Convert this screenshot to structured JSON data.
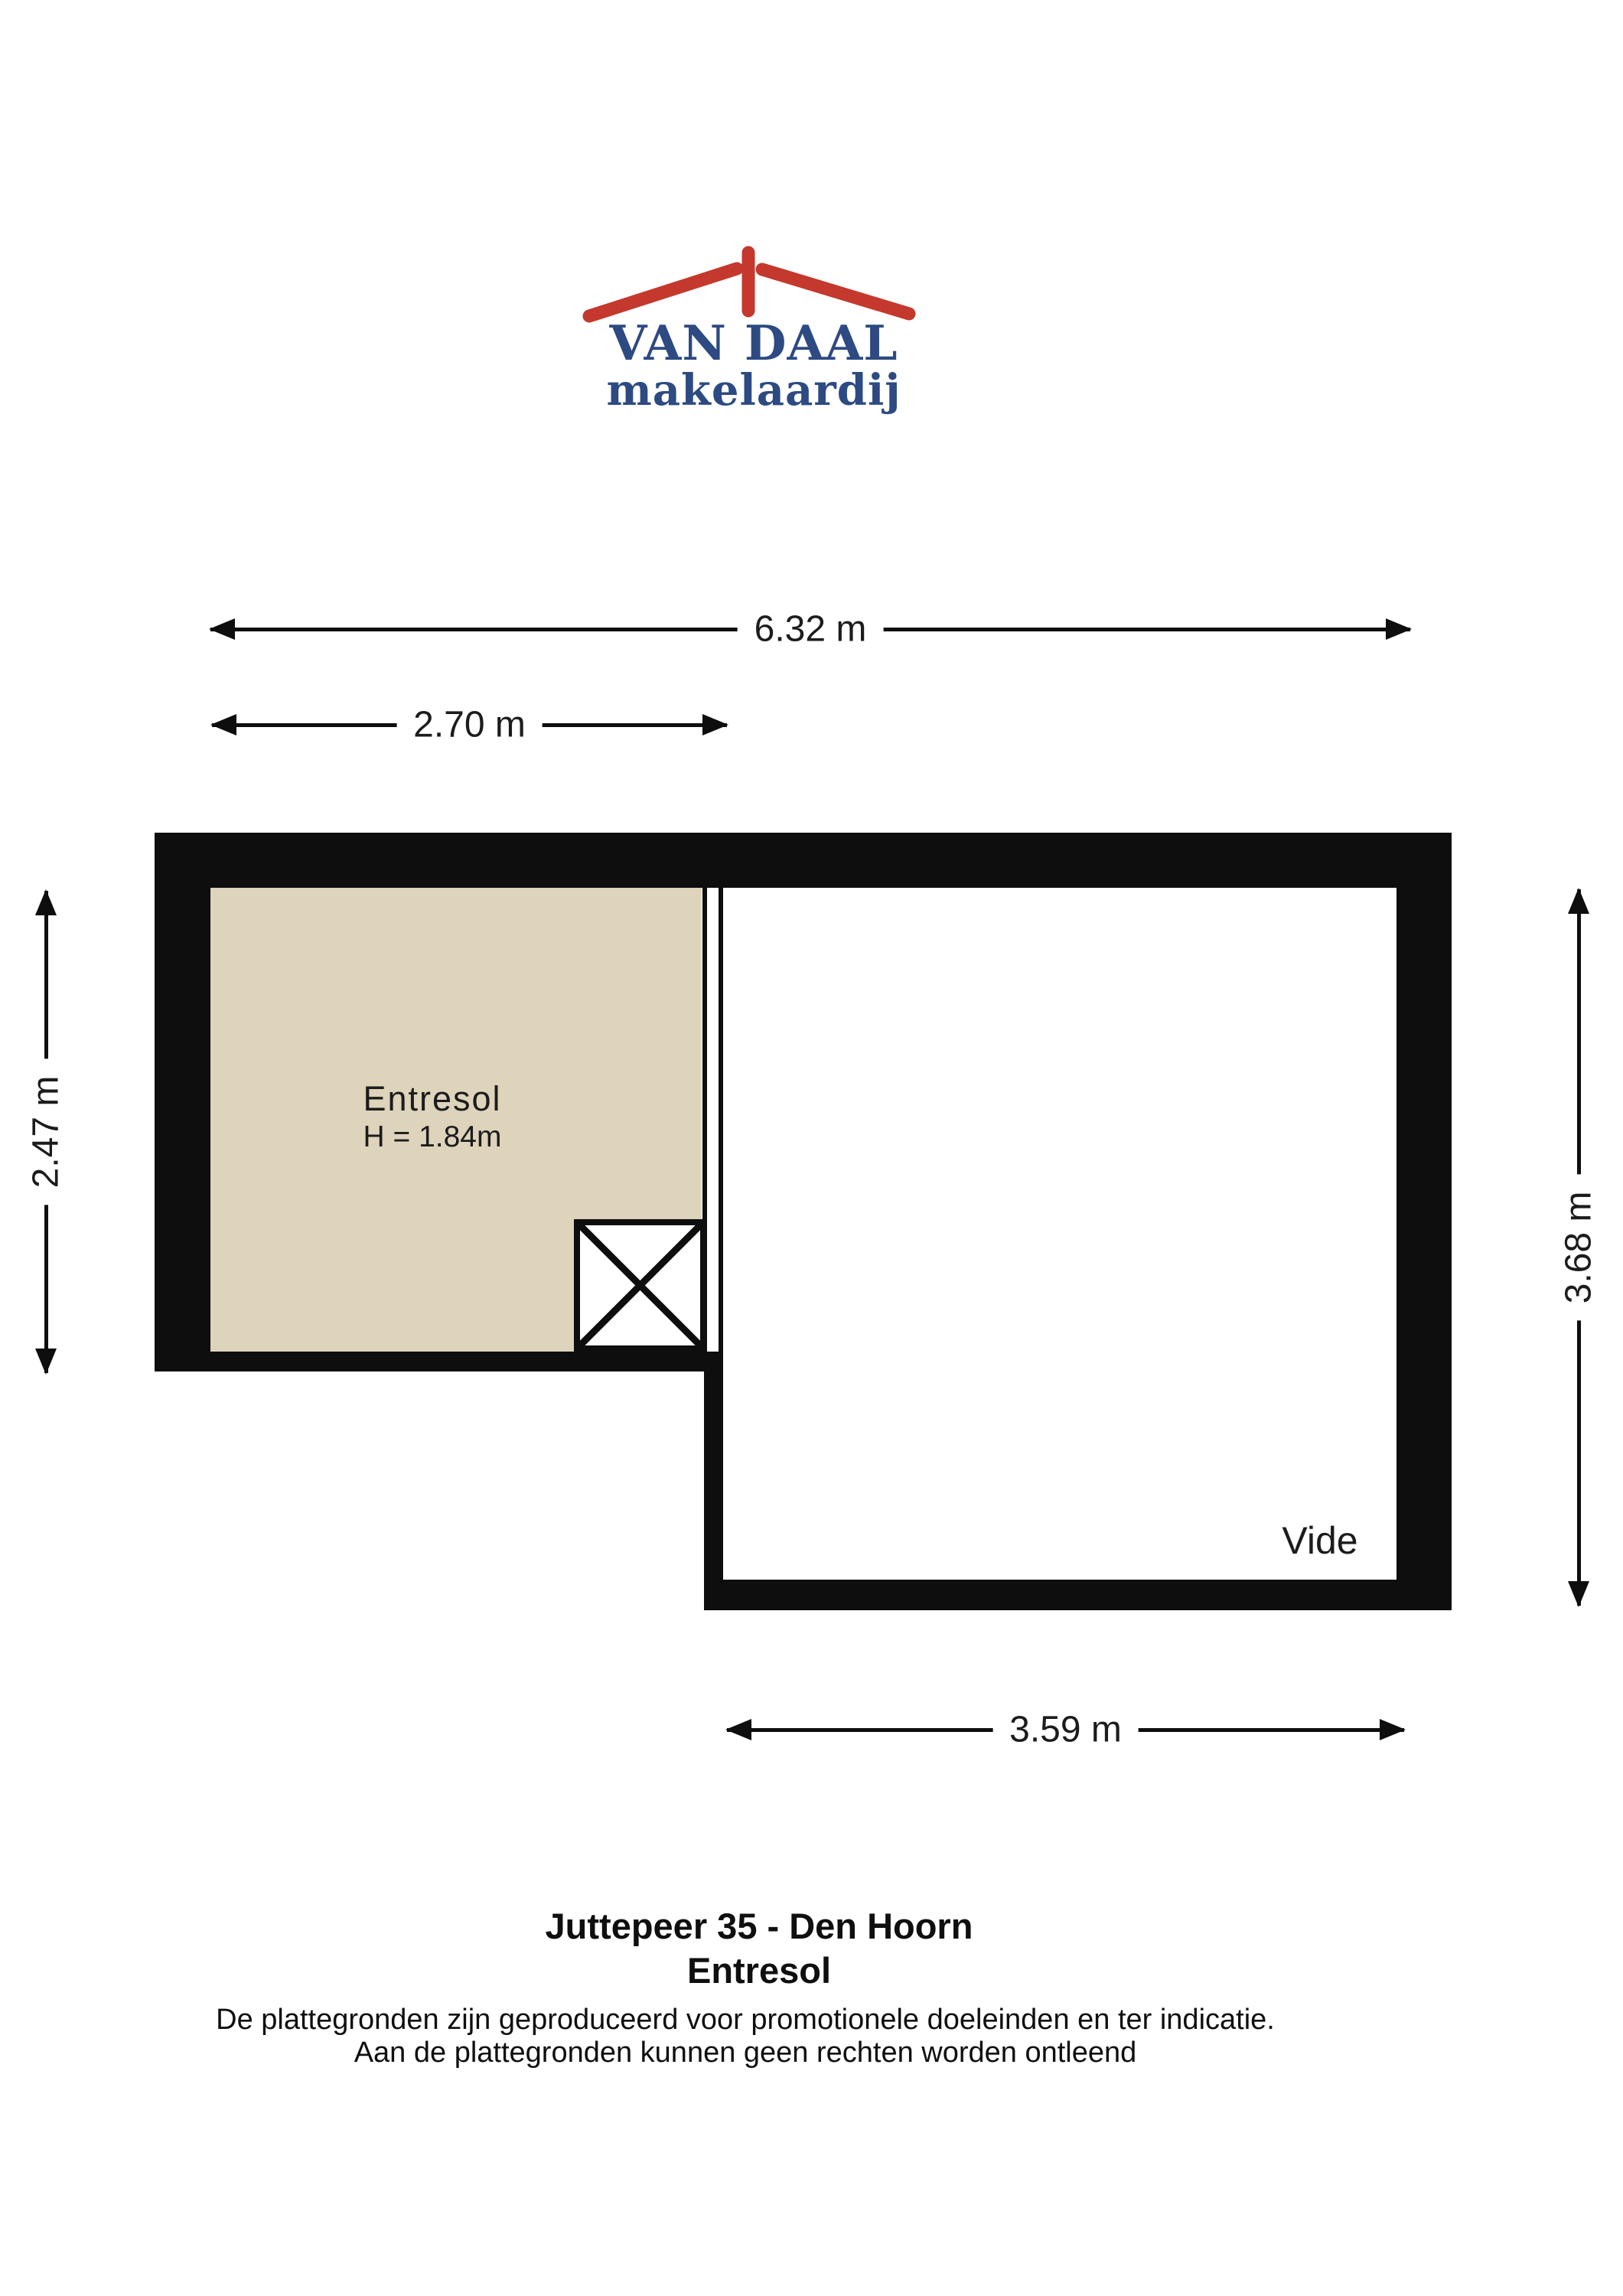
{
  "colors": {
    "brand-blue": "#2d4a82",
    "brand-red": "#c4382e",
    "wall": "#0e0e0e",
    "entresol-fill": "#ded3bb",
    "label": "#1c1c1c"
  },
  "logo": {
    "name": "VAN DAAL",
    "tagline": "makelaardij"
  },
  "dimensions": {
    "overall_width": "6.32 m",
    "entresol_width": "2.70 m",
    "entresol_height": "2.47 m",
    "vide_height": "3.68 m",
    "vide_width": "3.59 m"
  },
  "floorplan": {
    "entresol": {
      "label": "Entresol",
      "ceiling_height": "H = 1.84m"
    },
    "vide": {
      "label": "Vide"
    }
  },
  "footer": {
    "address": "Juttepeer 35 - Den Hoorn",
    "level": "Entresol",
    "disclaimer1": "De plattegronden zijn geproduceerd voor promotionele doeleinden en ter indicatie.",
    "disclaimer2": "Aan de plattegronden kunnen geen rechten worden ontleend"
  }
}
